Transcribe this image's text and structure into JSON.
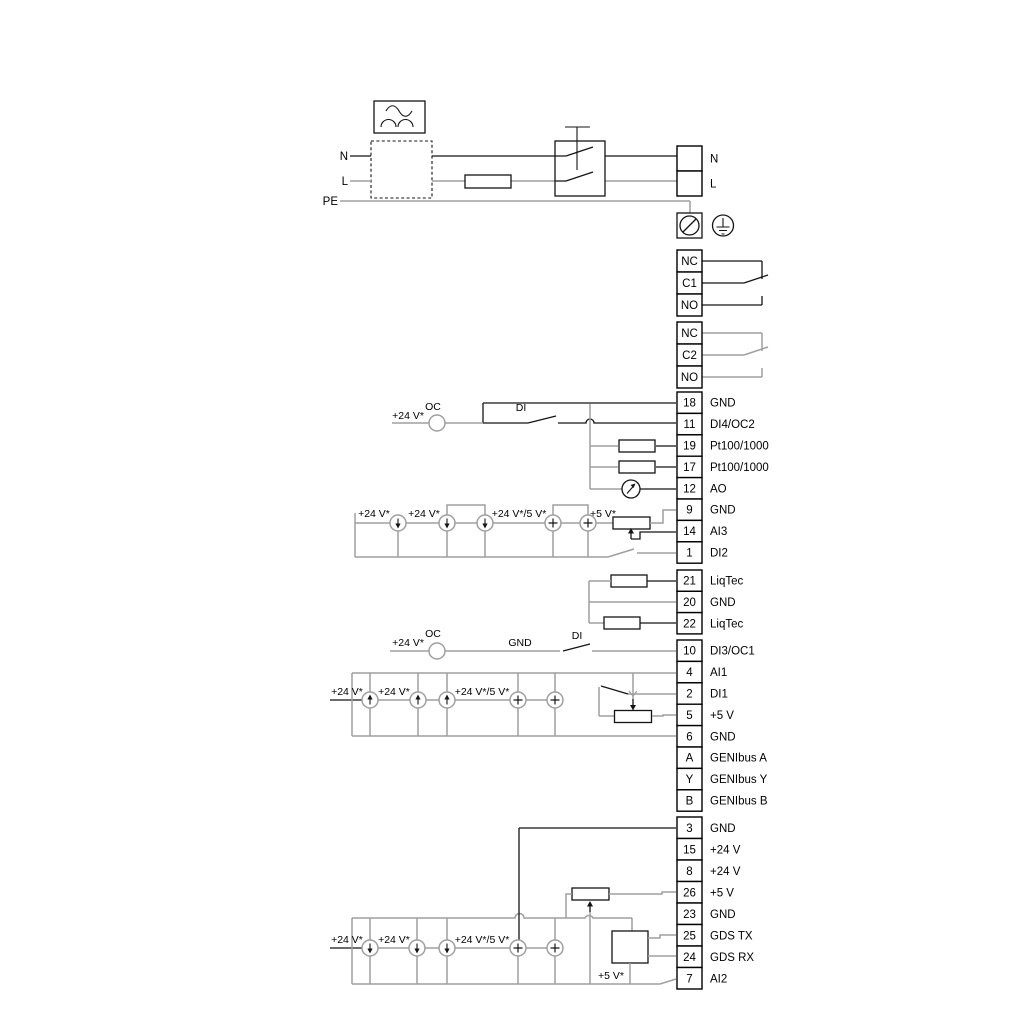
{
  "colors": {
    "wire_gray": "#9f9f9f",
    "wire_black": "#141414"
  },
  "diagram": {
    "labels": {
      "n": "N",
      "l": "L",
      "pe": "PE",
      "oc": "OC",
      "di": "DI",
      "gnd": "GND",
      "v24": "+24 V*",
      "v24_v5": "+24 V*/5 V*",
      "v5": "+5 V*"
    },
    "terminal_groups": {
      "mains": {
        "rows": [
          {
            "num": "",
            "label": "N"
          },
          {
            "num": "",
            "label": "L"
          }
        ]
      },
      "relay1": {
        "rows": [
          {
            "num": "NC",
            "label": ""
          },
          {
            "num": "C1",
            "label": ""
          },
          {
            "num": "NO",
            "label": ""
          }
        ]
      },
      "relay2": {
        "rows": [
          {
            "num": "NC",
            "label": ""
          },
          {
            "num": "C2",
            "label": ""
          },
          {
            "num": "NO",
            "label": ""
          }
        ]
      },
      "io1": {
        "rows": [
          {
            "num": "18",
            "label": "GND"
          },
          {
            "num": "11",
            "label": "DI4/OC2"
          },
          {
            "num": "19",
            "label": "Pt100/1000"
          },
          {
            "num": "17",
            "label": "Pt100/1000"
          },
          {
            "num": "12",
            "label": "AO"
          },
          {
            "num": "9",
            "label": "GND"
          },
          {
            "num": "14",
            "label": "AI3"
          },
          {
            "num": "1",
            "label": "DI2"
          }
        ]
      },
      "liqtec": {
        "rows": [
          {
            "num": "21",
            "label": "LiqTec"
          },
          {
            "num": "20",
            "label": "GND"
          },
          {
            "num": "22",
            "label": "LiqTec"
          }
        ]
      },
      "io2": {
        "rows": [
          {
            "num": "10",
            "label": "DI3/OC1"
          },
          {
            "num": "4",
            "label": "AI1"
          },
          {
            "num": "2",
            "label": "DI1"
          },
          {
            "num": "5",
            "label": "+5 V"
          },
          {
            "num": "6",
            "label": "GND"
          },
          {
            "num": "A",
            "label": "GENIbus A"
          },
          {
            "num": "Y",
            "label": "GENIbus Y"
          },
          {
            "num": "B",
            "label": "GENIbus B"
          }
        ]
      },
      "io3": {
        "rows": [
          {
            "num": "3",
            "label": "GND"
          },
          {
            "num": "15",
            "label": "+24 V"
          },
          {
            "num": "8",
            "label": "+24 V"
          },
          {
            "num": "26",
            "label": "+5 V"
          },
          {
            "num": "23",
            "label": "GND"
          },
          {
            "num": "25",
            "label": "GDS TX"
          },
          {
            "num": "24",
            "label": "GDS RX"
          },
          {
            "num": "7",
            "label": "AI2"
          }
        ]
      }
    }
  }
}
